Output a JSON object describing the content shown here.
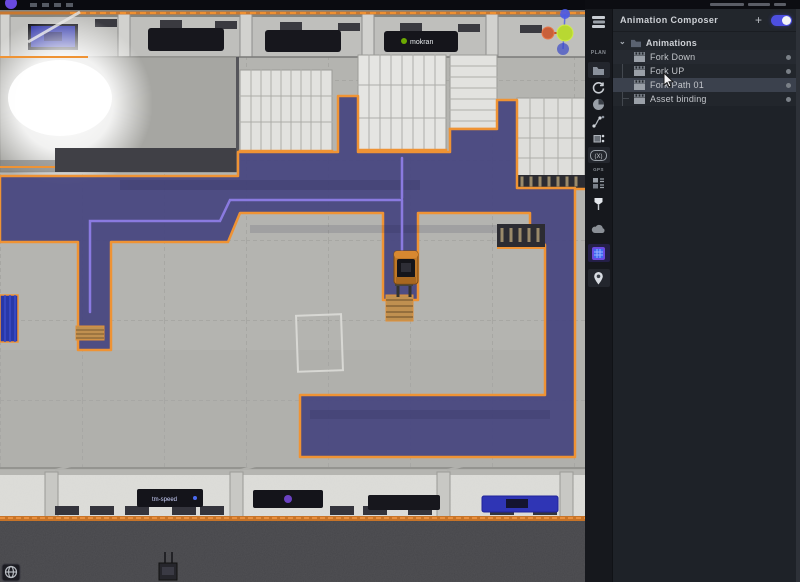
{
  "topbar": {
    "logo": "omniverse-logo"
  },
  "icons": {
    "plus": "+",
    "chevron": "⌄"
  },
  "toolbar": {
    "plan_label": "PLAN",
    "gps_label": "GPS",
    "xf_label": "(X)",
    "icon_names": [
      "layers-stack",
      "plan-label",
      "folder",
      "refresh",
      "pie-chart",
      "path-nodes",
      "vertex-edit",
      "xf-badge",
      "gps-label",
      "crates",
      "pin-lamp",
      "cloud",
      "navmesh-tool",
      "location-marker"
    ]
  },
  "panel": {
    "title": "Animation Composer",
    "toggle_on": true,
    "group": {
      "label": "Animations",
      "expanded": true
    },
    "items": [
      {
        "label": "Fork Down",
        "selected": false
      },
      {
        "label": "Fork UP",
        "selected": false
      },
      {
        "label": "Fork Path 01",
        "selected": true
      },
      {
        "label": "Asset binding",
        "selected": false
      }
    ]
  },
  "viewport": {
    "top_banner_brand": "mokran",
    "dock_banner_brand": "tm-speed",
    "colors": {
      "navmesh_fill": "#474680",
      "navmesh_outline": "#EF9334",
      "path_line": "#8A7AE0",
      "floor": "#B4B4B0",
      "gizmo_x": "#C9603A",
      "gizmo_center": "#B8D832",
      "gizmo_z": "#4A5AE8",
      "toggle_accent": "#4D4FE0"
    },
    "objects": [
      "forklift",
      "pallet-stack",
      "pallet",
      "shelf-racks",
      "navmesh-region",
      "nav-path",
      "blue-mat",
      "floor-marking-square",
      "dock-wall",
      "axis-gizmo",
      "globe-button"
    ]
  }
}
